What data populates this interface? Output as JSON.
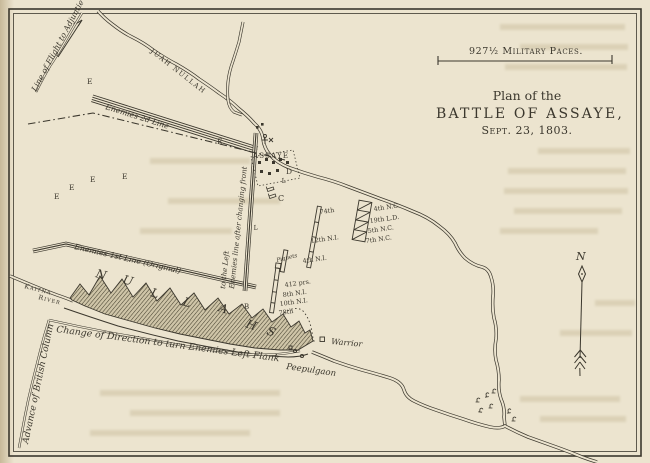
{
  "colors": {
    "paper": "#ece4cf",
    "ink": "#3b372d"
  },
  "scale_bar": {
    "label": "927½ Military Paces."
  },
  "title": {
    "line1": "Plan of the",
    "line2": "BATTLE OF ASSAYE,",
    "line3": "Sept. 23, 1803."
  },
  "compass": {
    "north": "N"
  },
  "rivers": {
    "juah_label": "JUAH NULLAH",
    "kaitna_label_1": "Kaitna",
    "kaitna_label_2": "River",
    "nullah_letters": [
      "N",
      "U",
      "L",
      "L",
      "A",
      "H",
      "S"
    ]
  },
  "movement_labels": {
    "flight": "Line of Flight to Adjuntie",
    "advance": "Advance of British Column",
    "change_direction": "Change of Direction to turn Enemies Left Flank"
  },
  "enemy_lines": {
    "second": "Enemies 2d Line",
    "first": "Enemies 1st Line (Original)",
    "changed_front_1": "Enemies line after changing front",
    "changed_front_2": "to the Left"
  },
  "villages": {
    "assaye": "ASSAYE",
    "warrior": "Warrior",
    "peepulgaon": "Peepulgaon"
  },
  "units": {
    "second_line_bar": [
      "74th",
      "12th N.I."
    ],
    "piquets_bar": [
      "Piquets",
      "4th N.I."
    ],
    "first_line_bar": [
      "412 prs.",
      "8th N.I.",
      "10th N.I.",
      "78th"
    ],
    "cavalry_block": [
      "4th N.C.",
      "19th L.D.",
      "5th N.C.",
      "7th N.C."
    ]
  },
  "markers": {
    "e_letters": [
      "E",
      "E",
      "E",
      "E",
      "E",
      "E"
    ],
    "b": "B",
    "c": "C",
    "d": "D",
    "l_1": "L",
    "l_2": "L"
  }
}
